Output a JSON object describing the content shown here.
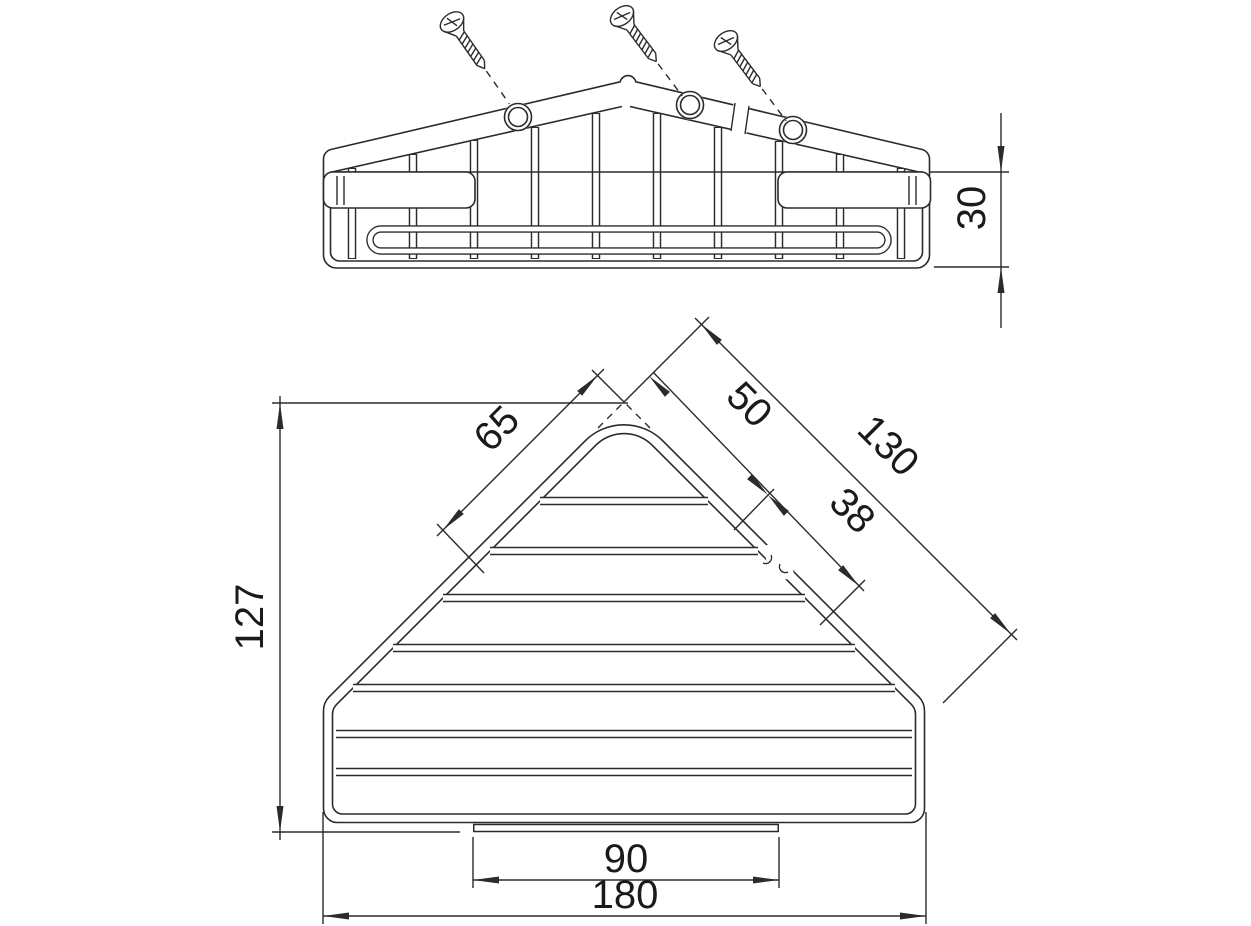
{
  "page": {
    "background": "#ffffff",
    "line_color": "#2b2b2b",
    "text_color": "#1a1a1a"
  },
  "views": {
    "front_view": "corner basket front elevation with three mounting screws",
    "plan_view": "corner basket top view"
  },
  "dimensions": {
    "basket_height": "30",
    "plan_depth": "127",
    "left_edge_segment": "65",
    "right_edge_first": "50",
    "right_edge_second": "38",
    "right_edge_total": "130",
    "front_lip_width": "90",
    "overall_width": "180"
  }
}
